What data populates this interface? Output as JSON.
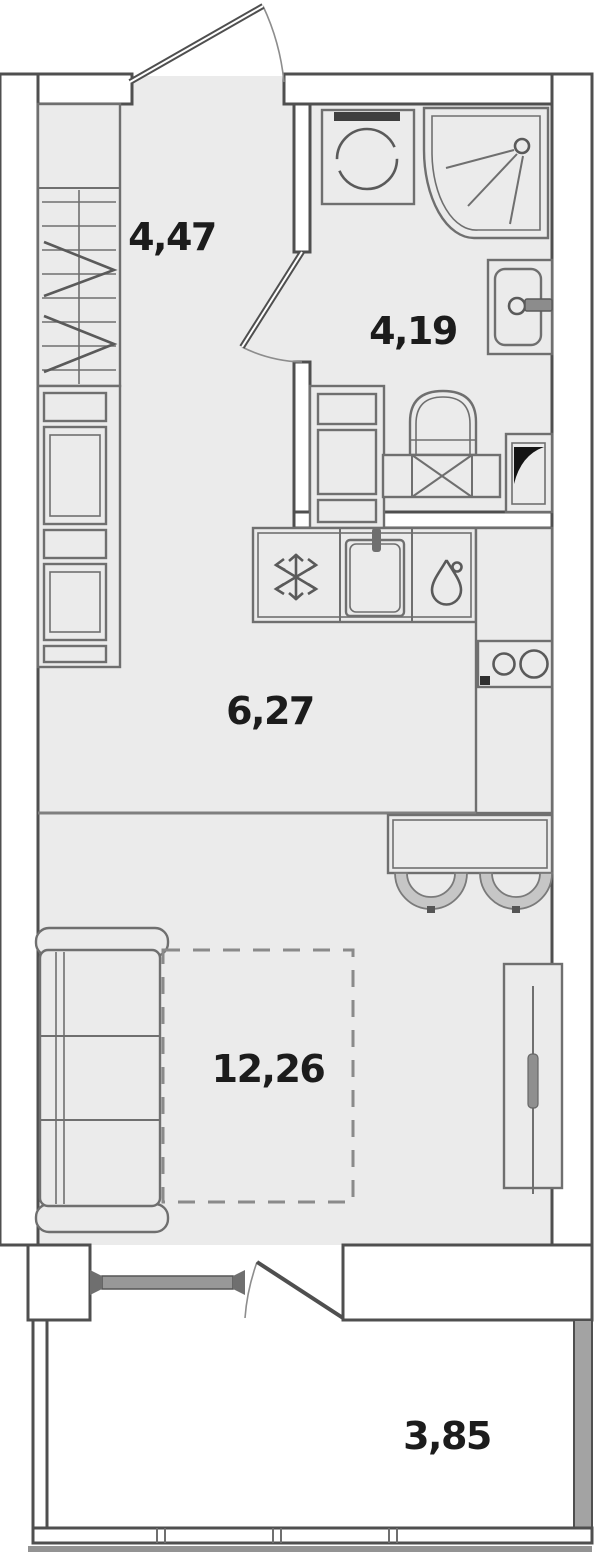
{
  "plan": {
    "rooms": [
      {
        "name": "hallway",
        "area": "4,47"
      },
      {
        "name": "bathroom",
        "area": "4,19"
      },
      {
        "name": "kitchen",
        "area": "6,27"
      },
      {
        "name": "living-room",
        "area": "12,26"
      },
      {
        "name": "balcony",
        "area": "3,85"
      }
    ],
    "fixtures": [
      "entrance-door",
      "wardrobe",
      "kitchen-cabinets",
      "washing-machine",
      "corner-shower",
      "washbasin",
      "toilet",
      "ventilation-shaft",
      "kitchen-counter",
      "fridge-snowflake",
      "kitchen-sink",
      "water-drop",
      "hob-two-burners",
      "bar-table",
      "stool",
      "stool",
      "sofa",
      "bed-dashed-outline",
      "sliding-wardrobe",
      "balcony-door",
      "window",
      "balcony-glazing"
    ],
    "colors": {
      "floor": "#ebebeb",
      "wall": "#4f4f4f",
      "furniture": "#6f6f6f",
      "fixture": "#5a5a5a",
      "label": "#1c1c1c",
      "glass": "#989898",
      "balcony_wall": "#a3a3a3",
      "ground": "#939393",
      "dark": "#3e3e3e"
    }
  }
}
